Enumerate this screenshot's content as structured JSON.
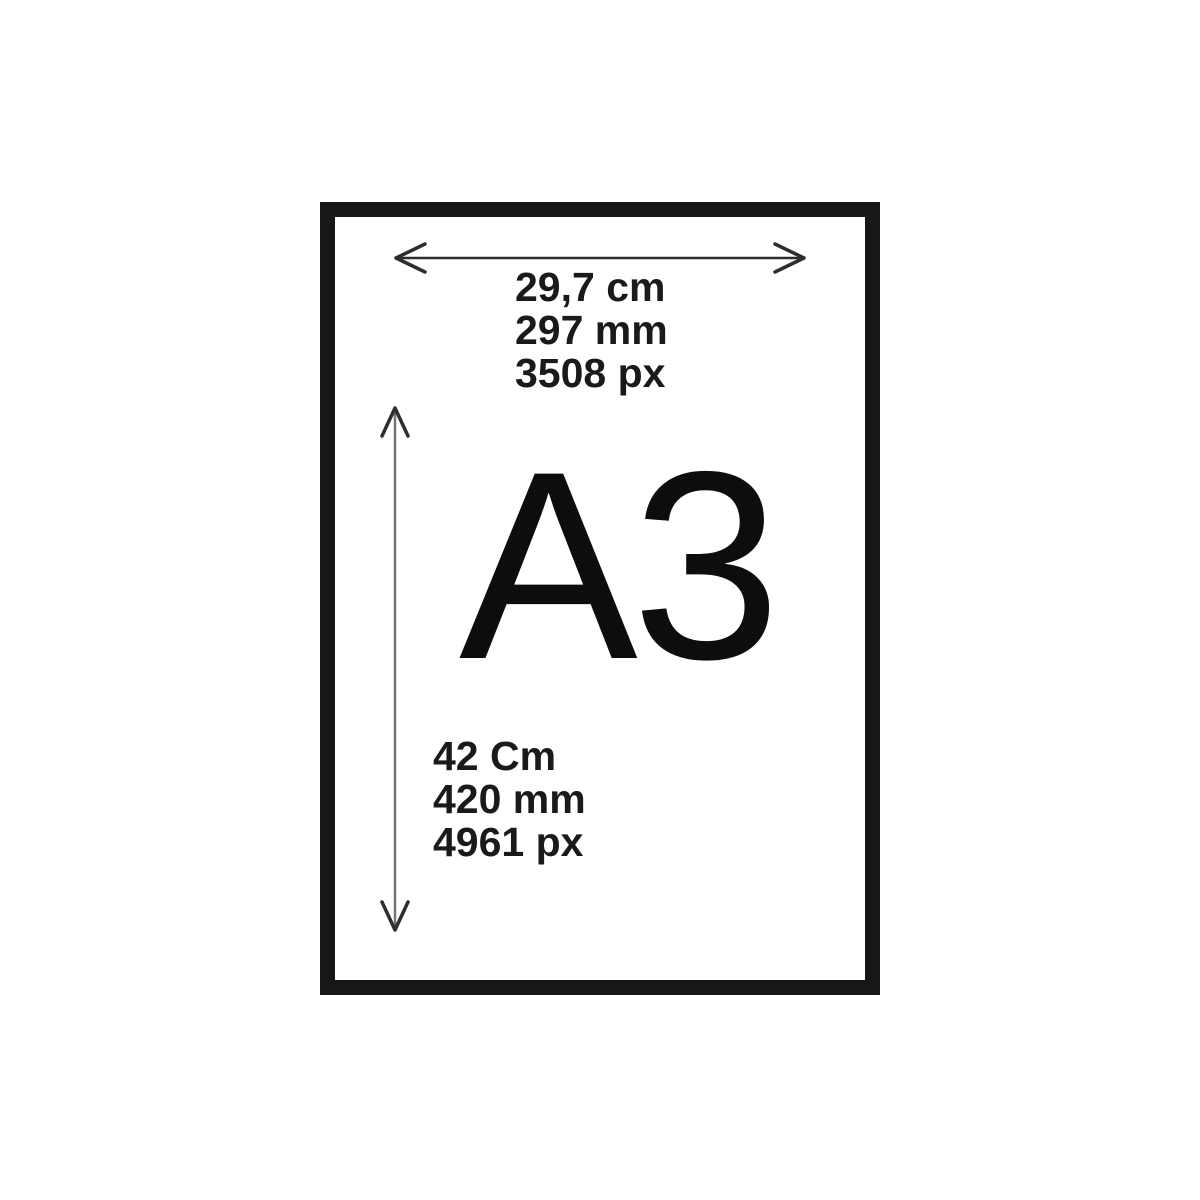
{
  "paper": {
    "size_label": "A3",
    "width_dimension": {
      "cm": "29,7 cm",
      "mm": "297 mm",
      "px": "3508 px"
    },
    "height_dimension": {
      "cm": "42 Cm",
      "mm": "420 mm",
      "px": "4961 px"
    }
  },
  "colors": {
    "background": "#ffffff",
    "frame_border": "#171717",
    "label_text": "#1a1a1a",
    "width_arrow": "#2e2e2e",
    "height_arrow_line": "#757575",
    "height_arrow_heads": "#2e2e2e"
  },
  "icons": {
    "width_arrow": "horizontal-double-arrow-icon",
    "height_arrow": "vertical-double-arrow-icon"
  }
}
